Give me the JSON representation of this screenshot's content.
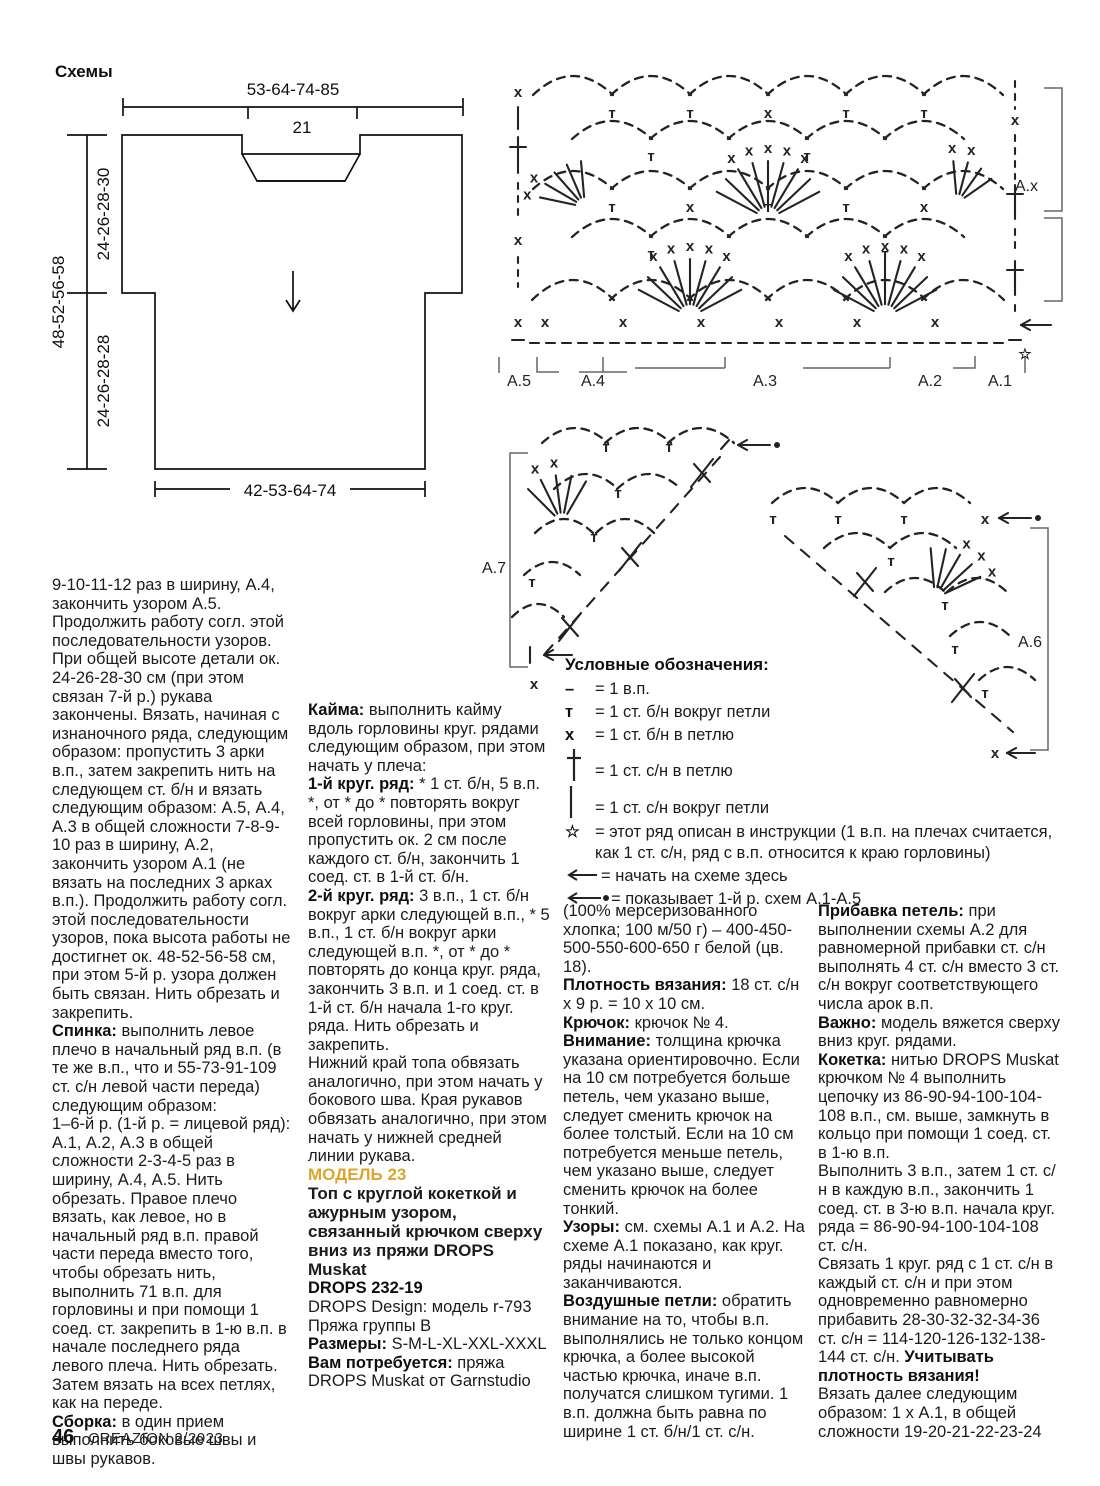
{
  "page": {
    "footer": {
      "page_number": "46",
      "magazine": "CREAZION 2/2023"
    }
  },
  "colors": {
    "accent_gold": "#DCA62E",
    "ink": "#1b1b1b"
  },
  "schematic": {
    "title": "Схемы",
    "top_width": "53-64-74-85",
    "neck_width": "21",
    "yoke_height": "24-26-28-30",
    "total_height": "48-52-56-58",
    "body_height": "24-26-28-28",
    "bottom_width": "42-53-64-74"
  },
  "charts": {
    "main": {
      "labels": [
        "A.5",
        "A.4",
        "A.3",
        "A.2",
        "A.1"
      ],
      "label_right": "A.x"
    },
    "tri_left_label": "A.7",
    "tri_right_label": "A.6"
  },
  "legend": {
    "title": "Условные обозначения:",
    "items": [
      {
        "glyph": "–",
        "icon": "chain-dash",
        "text": "= 1 в.п."
      },
      {
        "glyph": "т",
        "icon": "sc-around-loop",
        "text": "= 1 ст. б/н вокруг петли"
      },
      {
        "glyph": "x",
        "icon": "sc-in-stitch",
        "text": "= 1 ст. б/н в петлю"
      },
      {
        "glyph": "",
        "icon": "dc-in-stitch",
        "text": "= 1 ст. с/н в петлю"
      },
      {
        "glyph": "",
        "icon": "dc-around-loop",
        "text": "= 1 ст. с/н вокруг петли"
      },
      {
        "glyph": "☆",
        "icon": "star",
        "text": "= этот ряд описан в инструкции (1 в.п. на плечах считается, как 1 ст. с/н, ряд с в.п. относится к краю горловины)"
      },
      {
        "glyph": "",
        "icon": "arrow-left",
        "text": "= начать на схеме здесь"
      },
      {
        "glyph": "",
        "icon": "arrow-left-dot",
        "text": "= показывает 1-й р. схем А.1-А.5"
      }
    ]
  },
  "columns": {
    "col1": {
      "p1": "9-10-11-12 раз в ширину, А.4, закончить узором А.5. Продолжить работу согл. этой последовательности узоров. При общей высоте детали ок. 24-26-28-30 см (при этом связан 7-й р.) рукава закончены. Вязать, начиная с изнаночного ряда, следующим образом: пропустить 3 арки в.п., затем закрепить нить на следующем ст. б/н и вязать следующим образом: А.5, А.4, А.3 в общей сложности 7-8-9-10 раз в ширину, А.2, закончить узором А.1 (не вязать на последних 3 арках в.п.). Продолжить работу согл. этой последовательности узоров, пока высота работы не достигнет ок. 48-52-56-58 см, при этом 5-й р. узора должен быть связан. Нить обрезать и закрепить.",
      "p2_lead": "Спинка:",
      "p2": "выполнить левое плечо в начальный ряд в.п. (в те же в.п., что и 55-73-91-109 ст. с/н левой части переда) следующим образом:",
      "p3": "1–6-й р. (1-й р. = лицевой ряд): А.1, А.2, А.3 в общей сложности 2-3-4-5 раз в ширину, А.4, А.5. Нить обрезать. Правое плечо вязать, как левое, но в начальный ряд в.п. правой части переда вместо того, чтобы обрезать нить, выполнить 71 в.п. для горловины и при помощи 1 соед. ст. закрепить в 1-ю в.п. в начале последнего ряда левого плеча. Нить обрезать. Затем вязать на всех петлях, как на переде.",
      "p4_lead": "Сборка:",
      "p4": "в один прием выполнить боковые швы и швы рукавов."
    },
    "col2": {
      "p1_lead": "Кайма:",
      "p1": "выполнить кайму вдоль горловины круг. рядами следующим образом, при этом начать у плеча:",
      "p2_lead": "1-й круг. ряд:",
      "p2": "* 1 ст. б/н, 5 в.п. *, от * до * повторять вокруг всей горловины, при этом пропустить ок. 2 см после каждого ст. б/н, закончить 1 соед. ст. в 1-й ст. б/н.",
      "p3_lead": "2-й круг. ряд:",
      "p3": "3 в.п., 1 ст. б/н вокруг арки следующей в.п., * 5 в.п., 1 ст. б/н вокруг арки следующей в.п. *, от * до * повторять до конца круг. ряда, закончить 3 в.п. и 1 соед. ст. в 1-й ст. б/н начала 1-го круг. ряда. Нить обрезать и закрепить.",
      "p4": "Нижний край топа обвязать аналогично, при этом начать у бокового шва. Края рукавов обвязать аналогично, при этом начать у нижней средней линии рукава.",
      "model_heading": "МОДЕЛЬ 23",
      "model_title": "Топ с круглой кокеткой и ажурным узором, связанный крючком сверху вниз из пряжи DROPS Muskat",
      "design_code": "DROPS 232-19",
      "design_line1": "DROPS Design: модель r-793",
      "design_line2": "Пряжа группы B",
      "sizes_lead": "Размеры:",
      "sizes": "S-M-L-XL-XXL-XXXL",
      "need_lead": "Вам потребуется:",
      "need": "пряжа DROPS Muskat от Garnstudio"
    },
    "col3": {
      "p1": "(100% мерсеризованного хлопка; 100 м/50 г) – 400-450-500-550-600-650 г белой (цв. 18).",
      "p2_lead": "Плотность вязания:",
      "p2": "18 ст. с/н x 9 р. = 10 x 10 см.",
      "p3_lead": "Крючок:",
      "p3": "крючок № 4.",
      "p4_lead": "Внимание:",
      "p4": "толщина крючка указана ориентировочно. Если на 10 см потребуется больше петель, чем указано выше, следует сменить крючок на более толстый. Если на 10 см потребуется меньше петель, чем указано выше, следует сменить крючок на более тонкий.",
      "p5_lead": "Узоры:",
      "p5": "см. схемы А.1 и А.2. На схеме А.1 показано, как круг. ряды начинаются и заканчиваются.",
      "p6_lead": "Воздушные петли:",
      "p6": "обратить внимание на то, чтобы в.п. выполнялись не только концом крючка, а более высокой частью крючка, иначе в.п. получатся слишком тугими. 1 в.п. должна быть равна по ширине 1 ст. б/н/1 ст. с/н."
    },
    "col4": {
      "p1_lead": "Прибавка петель:",
      "p1": "при выполнении схемы А.2 для равномерной прибавки ст. с/н выполнять 4 ст. с/н вместо 3 ст. с/н вокруг соответствующего числа арок в.п.",
      "p2_lead": "Важно:",
      "p2": "модель вяжется сверху вниз круг. рядами.",
      "p3_lead": "Кокетка:",
      "p3": "нитью DROPS Muskat крючком № 4 выполнить цепочку из 86-90-94-100-104-108 в.п., см. выше, замкнуть в кольцо при помощи 1 соед. ст. в 1-ю в.п.",
      "p4": "Выполнить 3 в.п., затем 1 ст. с/н в каждую в.п., закончить 1 соед. ст. в 3-ю в.п. начала круг. ряда = 86-90-94-100-104-108 ст. с/н.",
      "p5": "Связать 1 круг. ряд с 1 ст. с/н в каждый ст. с/н и при этом одновременно равномерно прибавить 28-30-32-32-34-36 ст. с/н = 114-120-126-132-138-144 ст. с/н.",
      "p5_bold_tail": "Учитывать плотность вязания!",
      "p6": "Вязать далее следующим образом: 1 x А.1, в общей сложности 19-20-21-22-23-24"
    }
  }
}
